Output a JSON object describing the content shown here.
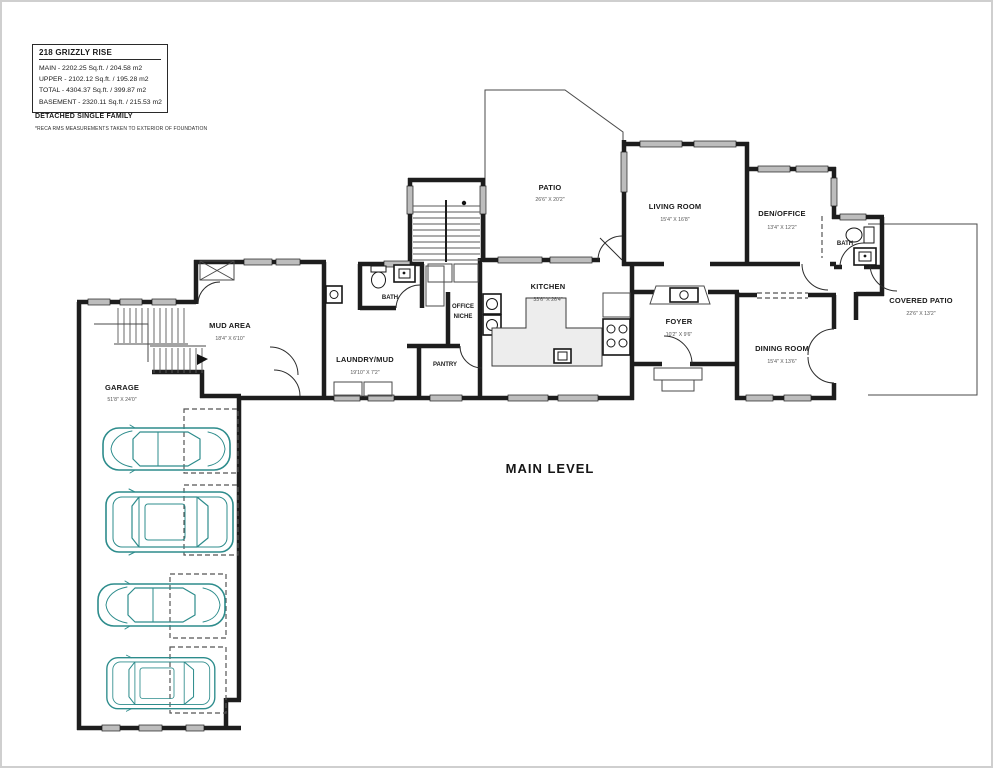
{
  "info_box": {
    "title": "218 GRIZZLY RISE",
    "main": "MAIN - 2202.25 Sq.ft. / 204.58 m2",
    "upper": "UPPER - 2102.12 Sq.ft. / 195.28 m2",
    "total": "TOTAL - 4304.37 Sq.ft. / 399.87 m2",
    "basement": "BASEMENT - 2320.11 Sq.ft. / 215.53 m2",
    "property_type": "DETACHED SINGLE FAMILY",
    "disclaimer": "*RECA RMS MEASUREMENTS TAKEN TO EXTERIOR OF FOUNDATION"
  },
  "level_label": "MAIN LEVEL",
  "rooms": {
    "patio": {
      "name": "PATIO",
      "dims": "26'6\" X 20'2\""
    },
    "living": {
      "name": "LIVING ROOM",
      "dims": "15'4\" X 16'8\""
    },
    "den": {
      "name": "DEN/OFFICE",
      "dims": "13'4\" X 12'2\""
    },
    "bath_right": {
      "name": "BATH"
    },
    "covered": {
      "name": "COVERED PATIO",
      "dims": "22'6\" X 13'2\""
    },
    "kitchen": {
      "name": "KITCHEN",
      "dims": "33'6\" X 26'4\""
    },
    "foyer": {
      "name": "FOYER",
      "dims": "10'2\" X 9'6\""
    },
    "dining": {
      "name": "DINING ROOM",
      "dims": "15'4\" X 13'6\""
    },
    "mud": {
      "name": "MUD AREA",
      "dims": "18'4\" X 6'10\""
    },
    "laundry": {
      "name": "LAUNDRY/MUD",
      "dims": "19'10\" X 7'2\""
    },
    "bath_left": {
      "name": "BATH"
    },
    "office_niche": {
      "line1": "OFFICE",
      "line2": "NICHE"
    },
    "pantry": {
      "name": "PANTRY"
    },
    "garage": {
      "name": "GARAGE",
      "dims": "51'8\" X 24'0\""
    }
  },
  "colors": {
    "wall": "#1d1d1d",
    "window_fill": "#bdbdbd",
    "car": "#2d8c8c",
    "dash": "#555555",
    "accent_text": "#1a1a1a",
    "dim_text": "#555555"
  }
}
